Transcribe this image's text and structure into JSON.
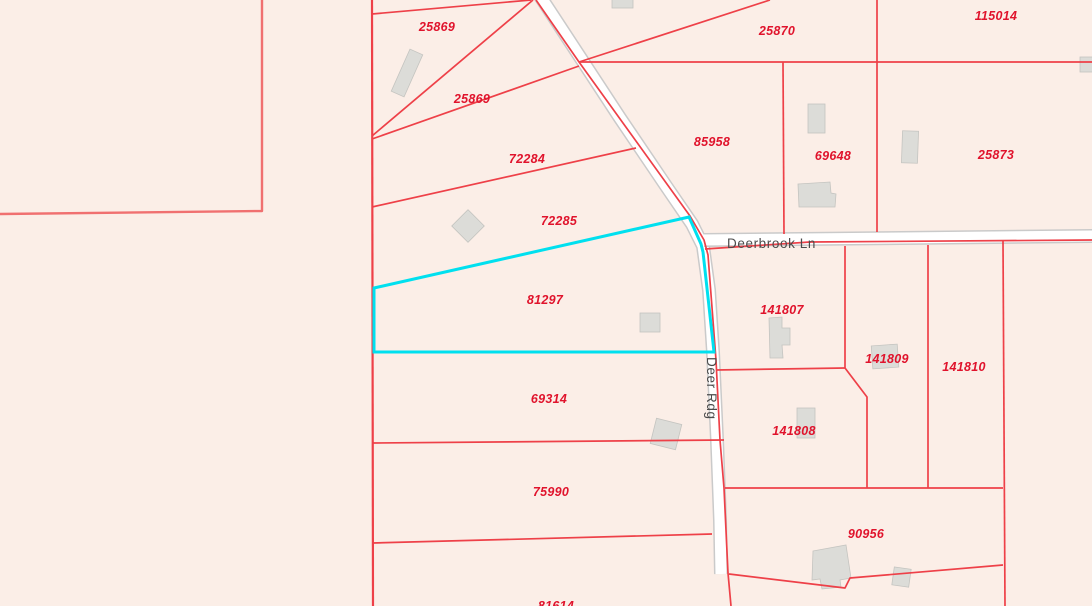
{
  "map": {
    "type": "parcel-map",
    "selected_parcel": "81297",
    "colors": {
      "background": "#fbeee7",
      "parcel_line": "#ee4048",
      "parcel_line_soft": "#f07070",
      "highlight": "#00e0ef",
      "parcel_label": "#e0132c",
      "street_label": "#4b4b4b",
      "road_fill": "#ffffff",
      "road_casing": "#cacaca",
      "building_fill": "#dcdcd8"
    },
    "roads": [
      {
        "name": "Deerbrook Ln"
      },
      {
        "name": "Deer Rdg"
      }
    ],
    "parcels": [
      {
        "label": "25869"
      },
      {
        "label": "25869"
      },
      {
        "label": "72284"
      },
      {
        "label": "72285"
      },
      {
        "label": "81297",
        "selected": true
      },
      {
        "label": "69314"
      },
      {
        "label": "75990"
      },
      {
        "label": "81614"
      },
      {
        "label": "85958"
      },
      {
        "label": "25870"
      },
      {
        "label": "115014"
      },
      {
        "label": "69648"
      },
      {
        "label": "25873"
      },
      {
        "label": "141807"
      },
      {
        "label": "141809"
      },
      {
        "label": "141810"
      },
      {
        "label": "141808"
      },
      {
        "label": "90956"
      }
    ]
  }
}
